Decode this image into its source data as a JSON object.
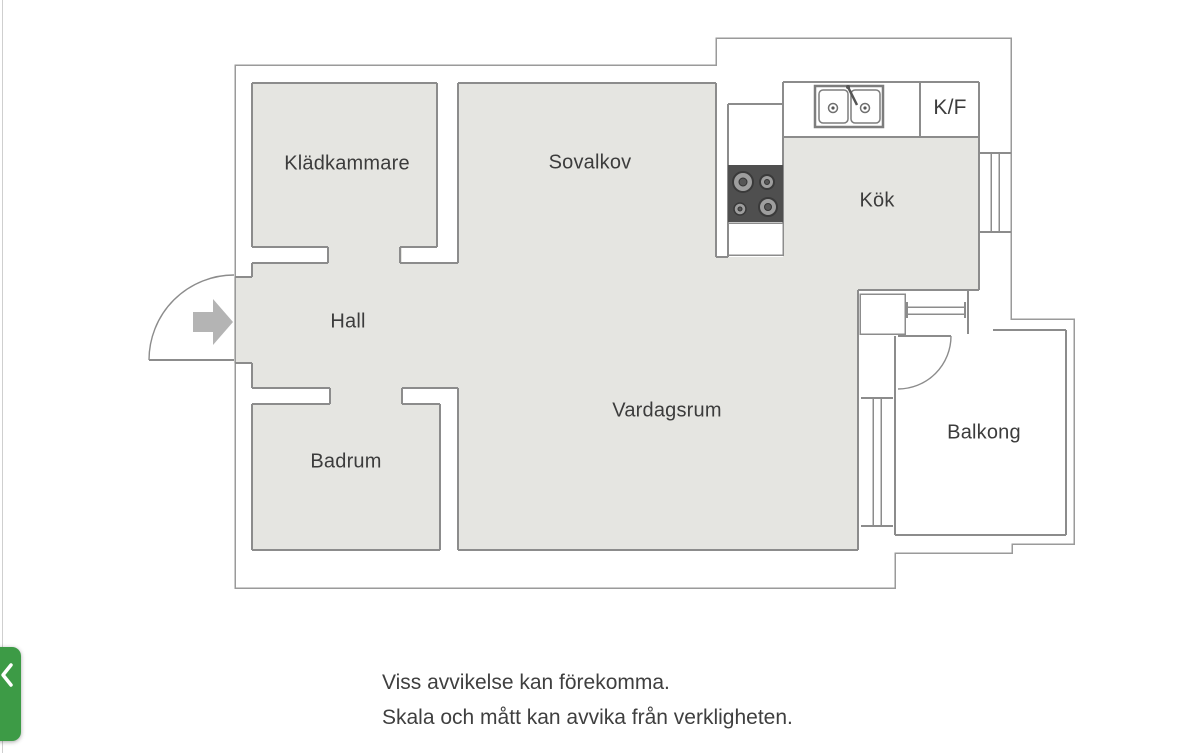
{
  "floorplan": {
    "rooms": [
      {
        "id": "kladkammare",
        "label": "Klädkammare"
      },
      {
        "id": "sovalkov",
        "label": "Sovalkov"
      },
      {
        "id": "kok",
        "label": "Kök"
      },
      {
        "id": "kf",
        "label": "K/F"
      },
      {
        "id": "hall",
        "label": "Hall"
      },
      {
        "id": "vardagsrum",
        "label": "Vardagsrum"
      },
      {
        "id": "badrum",
        "label": "Badrum"
      },
      {
        "id": "balkong",
        "label": "Balkong"
      }
    ],
    "fixtures": [
      "double-basin-sink",
      "four-burner-stove",
      "fridge-freezer-cabinet",
      "entrance-door-swing",
      "entrance-direction-arrow",
      "balcony-door-swing",
      "window-kitchen-east-wall",
      "window-kitchen-to-balcony",
      "window-livingroom-to-balcony"
    ],
    "colors": {
      "room_fill": "#e5e5e1",
      "wall_line": "#8c8c8c",
      "outer_line": "#9a9a9a",
      "stove_fill": "#4f4f4f",
      "burner_fill": "#9e9e9e",
      "arrow_fill": "#b4b4b4",
      "text": "#3c3c3c"
    }
  },
  "disclaimer": {
    "line1": "Viss avvikelse kan förekomma.",
    "line2": "Skala och mått kan avvika från verkligheten."
  },
  "back_button": {
    "color": "#3d9b46",
    "icon": "chevron-left"
  }
}
